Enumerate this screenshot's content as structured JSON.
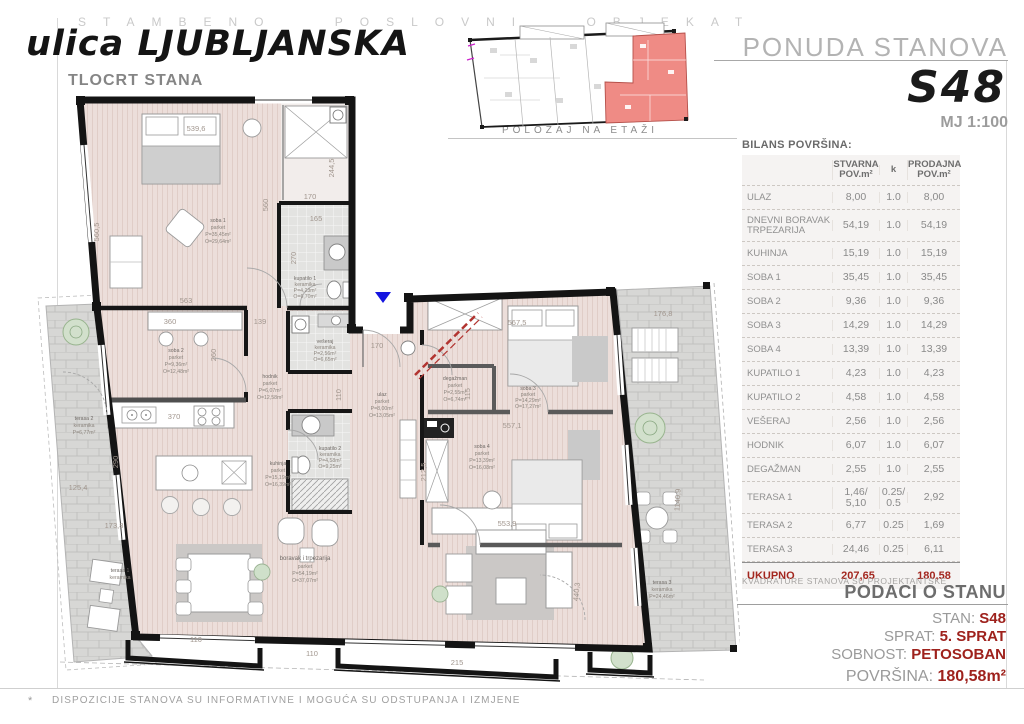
{
  "page": {
    "banner": "STAMBENO POSLOVNI OBJEKAT",
    "street_title": "ulica LJUBLJANSKA",
    "plan_title": "TLOCRT STANA",
    "footnote_mark": "*",
    "footnote": "DISPOZICIJE STANOVA SU INFORMATIVNE I MOGUĆA SU ODSTUPANJA I IZMJENE"
  },
  "position_diagram": {
    "caption": "POLOŽAJ NA ETAŽI"
  },
  "header": {
    "offer_title": "PONUDA STANOVA",
    "unit_code": "S48",
    "scale": "MJ 1:100"
  },
  "area_table": {
    "title": "BILANS POVRŠINA:",
    "col_stvarna": "STVARNA\nPOV.m²",
    "col_k": "k",
    "col_prodajna": "PRODAJNA\nPOV.m²",
    "rows": [
      {
        "label": "ULAZ",
        "stvarna": "8,00",
        "k": "1.0",
        "prodajna": "8,00"
      },
      {
        "label": "DNEVNI BORAVAK TRPEZARIJA",
        "stvarna": "54,19",
        "k": "1.0",
        "prodajna": "54,19"
      },
      {
        "label": "KUHINJA",
        "stvarna": "15,19",
        "k": "1.0",
        "prodajna": "15,19"
      },
      {
        "label": "SOBA 1",
        "stvarna": "35,45",
        "k": "1.0",
        "prodajna": "35,45"
      },
      {
        "label": "SOBA 2",
        "stvarna": "9,36",
        "k": "1.0",
        "prodajna": "9,36"
      },
      {
        "label": "SOBA 3",
        "stvarna": "14,29",
        "k": "1.0",
        "prodajna": "14,29"
      },
      {
        "label": "SOBA 4",
        "stvarna": "13,39",
        "k": "1.0",
        "prodajna": "13,39"
      },
      {
        "label": "KUPATILO 1",
        "stvarna": "4,23",
        "k": "1.0",
        "prodajna": "4,23"
      },
      {
        "label": "KUPATILO 2",
        "stvarna": "4,58",
        "k": "1.0",
        "prodajna": "4,58"
      },
      {
        "label": "VEŠERAJ",
        "stvarna": "2,56",
        "k": "1.0",
        "prodajna": "2,56"
      },
      {
        "label": "HODNIK",
        "stvarna": "6,07",
        "k": "1.0",
        "prodajna": "6,07"
      },
      {
        "label": "DEGAŽMAN",
        "stvarna": "2,55",
        "k": "1.0",
        "prodajna": "2,55"
      },
      {
        "label": "TERASA 1",
        "stvarna": "1,46/\n5,10",
        "k": "0.25/\n0.5",
        "prodajna": "2,92"
      },
      {
        "label": "TERASA 2",
        "stvarna": "6,77",
        "k": "0.25",
        "prodajna": "1,69"
      },
      {
        "label": "TERASA 3",
        "stvarna": "24,46",
        "k": "0.25",
        "prodajna": "6,11"
      }
    ],
    "total": {
      "label": "UKUPNO",
      "stvarna": "207,65",
      "prodajna": "180,58"
    },
    "note": "KVADRATURE STANOVA SU PROJEKTANTSKE"
  },
  "unit_info": {
    "title": "PODACI O STANU",
    "fields": [
      {
        "label": "STAN:",
        "value": "S48"
      },
      {
        "label": "SPRAT:",
        "value": "5. SPRAT"
      },
      {
        "label": "SOBNOST:",
        "value": "PETOSOBAN"
      },
      {
        "label": "POVRŠINA:",
        "value": "180,58m²"
      }
    ]
  },
  "plan": {
    "rooms": [
      {
        "l1": "soba 1",
        "l2": "parket",
        "l3": "P=35,45m²",
        "l4": "O=29,64m²"
      },
      {
        "l1": "kupatilo 1",
        "l2": "keramika",
        "l3": "P=4,23m²",
        "l4": "O=6,70m²"
      },
      {
        "l1": "vešeraj",
        "l2": "keramika",
        "l3": "P=2,56m²",
        "l4": "O=6,65m²"
      },
      {
        "l1": "soba 2",
        "l2": "parket",
        "l3": "P=9,36m²",
        "l4": "O=12,48m²"
      },
      {
        "l1": "kuhinja",
        "l2": "parket",
        "l3": "P=15,19m²",
        "l4": "O=16,39m²"
      },
      {
        "l1": "hodnik",
        "l2": "parket",
        "l3": "P=6,07m²",
        "l4": "O=12,58m²"
      },
      {
        "l1": "ulaz",
        "l2": "parket",
        "l3": "P=8,00m²",
        "l4": "O=13,05m²"
      },
      {
        "l1": "kupatilo 2",
        "l2": "keramika",
        "l3": "P=4,58m²",
        "l4": "O=9,25m²"
      },
      {
        "l1": "degažman",
        "l2": "parket",
        "l3": "P=2,55m²",
        "l4": "O=6,74m²"
      },
      {
        "l1": "soba 3",
        "l2": "parket",
        "l3": "P=14,29m²",
        "l4": "O=17,27m²"
      },
      {
        "l1": "soba 4",
        "l2": "parket",
        "l3": "P=13,39m²",
        "l4": "O=16,08m²"
      },
      {
        "l1": "boravak i trpezarija",
        "l2": "parket",
        "l3": "P=54,19m²",
        "l4": "O=37,07m²"
      },
      {
        "l1": "terasa 2",
        "l2": "keramika",
        "l3": "P=6,77m²",
        "l4": ""
      },
      {
        "l1": "terasa 1",
        "l2": "keramika",
        "l3": "",
        "l4": ""
      },
      {
        "l1": "terasa 3",
        "l2": "keramika",
        "l3": "P=24,46m²",
        "l4": ""
      }
    ],
    "dims": [
      "539,6",
      "560,5",
      "560",
      "244,5",
      "170",
      "165",
      "270",
      "563",
      "139",
      "360",
      "260",
      "370",
      "290",
      "110",
      "170",
      "567,5",
      "557,1",
      "553,9",
      "212,5",
      "115",
      "176,8",
      "440,3",
      "215",
      "110",
      "110",
      "125,4",
      "173,8",
      "1140,9"
    ],
    "colors": {
      "entrance_marker": "#1414e0",
      "shaft_line": "#b23430",
      "highlight_unit": "#ef8b85"
    }
  }
}
